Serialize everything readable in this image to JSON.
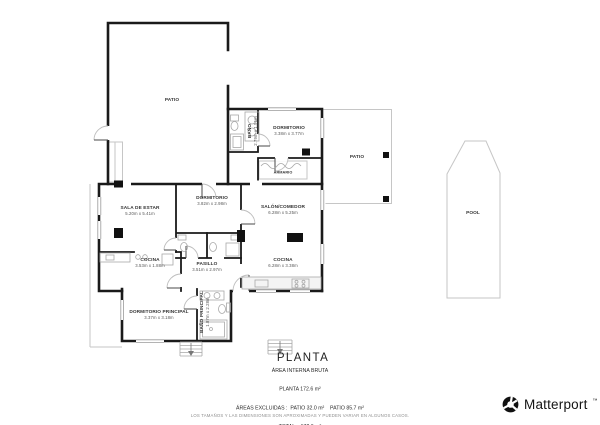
{
  "title": {
    "text": "PLANTA"
  },
  "rooms": [
    {
      "name": "PATIO",
      "dims": ""
    },
    {
      "name": "BAÑO",
      "dims": "2.79m x 1.51m"
    },
    {
      "name": "DORMITORIO",
      "dims": "3.38m x 3.77m"
    },
    {
      "name": "ARMARIO",
      "dims": ""
    },
    {
      "name": "PATIO",
      "dims": ""
    },
    {
      "name": "SALA DE ESTAR",
      "dims": "5.20m x 5.41m"
    },
    {
      "name": "DORMITORIO",
      "dims": "3.82m x 2.98m"
    },
    {
      "name": "COCINA",
      "dims": "3.53m x 1.88m"
    },
    {
      "name": "PASILLO",
      "dims": "3.51m x 2.97m"
    },
    {
      "name": "SALÓN/COMEDOR",
      "dims": "6.28m x 5.25m"
    },
    {
      "name": "COCINA",
      "dims": "6.28m x 3.38m"
    },
    {
      "name": "DORMITORIO PRINCIPAL",
      "dims": "3.37m x 3.18m"
    },
    {
      "name": "BAÑO PRINCIPAL",
      "dims": "1.87m x 2.28m"
    },
    {
      "name": "POOL",
      "dims": ""
    }
  ],
  "summary": {
    "heading": "ÁREA INTERNA BRUTA",
    "planta": "PLANTA 172.6 m²",
    "excluidas": "ÁREAS EXCLUIDAS :  PATIO 32.0 m²    PATIO 85.7 m²",
    "total": "TOTAL :  172.6 m²"
  },
  "disclaimer": "LOS TAMAÑOS Y LAS DIMENSIONES SON APROXIMADAS Y PUEDEN VARIAR EN ALGUNOS CASOS.",
  "brand": {
    "name": "Matterport",
    "tm": "™"
  },
  "colors": {
    "wall": "#1a1a1a",
    "light_outline": "#c6c6c6",
    "label_text": "#3a3a3a",
    "muted_text": "#8f8f8f"
  }
}
